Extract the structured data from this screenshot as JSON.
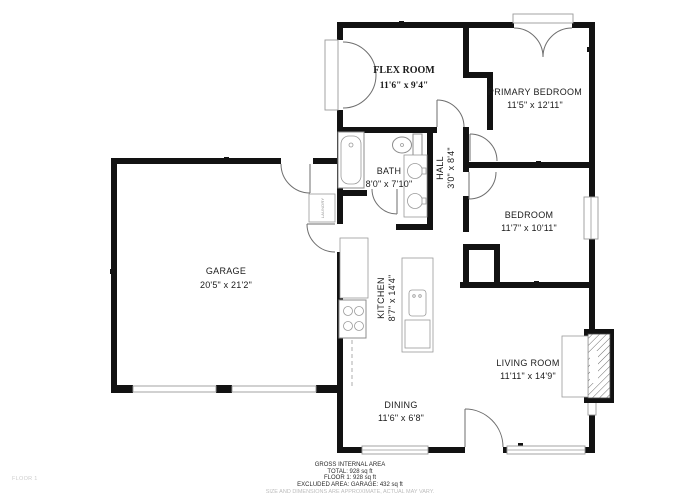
{
  "floor_label": "FLOOR 1",
  "rooms": {
    "flex": {
      "name": "FLEX ROOM",
      "dims": "11'6\" x 9'4\""
    },
    "primary_bedroom": {
      "name": "PRIMARY BEDROOM",
      "dims": "11'5\" x 12'11\""
    },
    "bath": {
      "name": "BATH",
      "dims": "8'0\" x 7'10\""
    },
    "hall": {
      "name": "HALL",
      "dims": "3'0\" x 8'4\""
    },
    "bedroom": {
      "name": "BEDROOM",
      "dims": "11'7\" x 10'11\""
    },
    "garage": {
      "name": "GARAGE",
      "dims": "20'5\" x 21'2\""
    },
    "kitchen": {
      "name": "KITCHEN",
      "dims": "8'7\" x 14'4\""
    },
    "living": {
      "name": "LIVING ROOM",
      "dims": "11'11\" x 14'9\""
    },
    "dining": {
      "name": "DINING",
      "dims": "11'6\" x 6'8\""
    },
    "laundry": {
      "name": "LAUNDRY"
    }
  },
  "footer": {
    "area_title": "GROSS INTERNAL AREA",
    "total": "TOTAL: 928 sq ft",
    "floor1": "FLOOR 1: 928 sq ft",
    "excluded": "EXCLUDED AREA: GARAGE: 432 sq ft",
    "disclaimer": "SIZE AND DIMENSIONS ARE APPROXIMATE, ACTUAL MAY VARY."
  },
  "colors": {
    "wall": "#121212",
    "door_arc": "#6e6e6e",
    "fixture": "#8d8d8d",
    "muted_text": "#bdbdbd"
  }
}
